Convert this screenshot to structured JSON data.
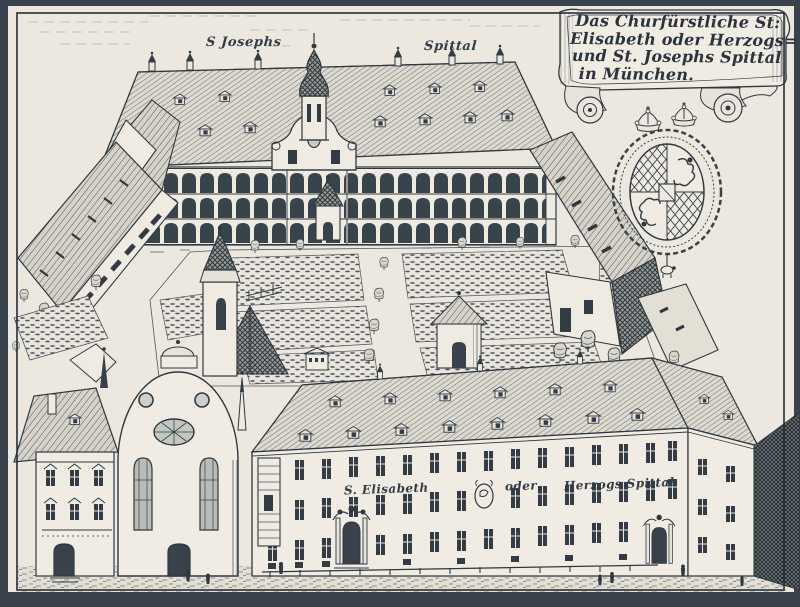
{
  "artwork": {
    "medium": "copper-engraving bird's-eye view",
    "banner": {
      "line1": "Das Churfürstliche St:",
      "line2": "Elisabeth oder Herzogs=",
      "line3": "und St. Josephs Spittal",
      "line4": "in München."
    },
    "labels": {
      "roof_left": "S Josephs",
      "roof_right": "Spittal",
      "facade_left": "S. Elisabeth",
      "facade_mid": "oder",
      "facade_right": "Herzogs Spittal"
    },
    "colors": {
      "paper": "#ece8df",
      "ink": "#2f3840",
      "frame": "#3a434d"
    }
  }
}
